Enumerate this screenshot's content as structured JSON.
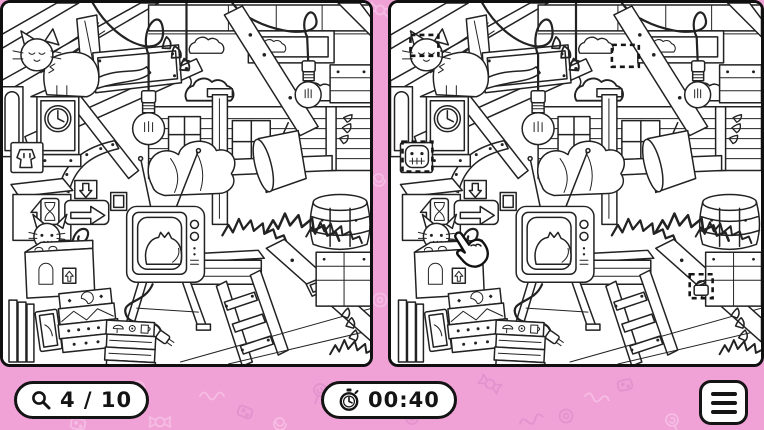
{
  "app": {
    "name": "Find the Differences",
    "scene": "cluttered attic line-art with cat, TV, clock, books and crates"
  },
  "colors": {
    "background_pink": "#F0A2D7",
    "pattern_pink": "#D27FC2",
    "panel_background": "#FFFFFF",
    "line_art": "#222222",
    "hud_background": "#FFFFFF",
    "hud_border": "#141414",
    "hud_text": "#141414"
  },
  "hud": {
    "found_counter": {
      "icon": "magnifier-icon",
      "label": "4 / 10",
      "found": 4,
      "total": 10
    },
    "timer": {
      "icon": "stopwatch-icon",
      "label": "00:40"
    },
    "menu": {
      "icon": "menu-icon"
    }
  },
  "panels": {
    "left": {
      "role": "original-scene"
    },
    "right": {
      "role": "modified-scene-with-differences"
    }
  },
  "differences": {
    "found_markers": [
      {
        "id": 1,
        "area": "cat-head",
        "x": 20,
        "y": 32,
        "w": 28,
        "h": 21
      },
      {
        "id": 2,
        "area": "wall-cloud",
        "x": 222,
        "y": 42,
        "w": 27,
        "h": 22
      },
      {
        "id": 3,
        "area": "wall-poster-face",
        "x": 12,
        "y": 139,
        "w": 30,
        "h": 30
      },
      {
        "id": 4,
        "area": "crate-padlock",
        "x": 300,
        "y": 272,
        "w": 23,
        "h": 24
      }
    ],
    "cursor": {
      "icon": "pointing-hand-cursor",
      "x": 68,
      "y": 234
    }
  }
}
